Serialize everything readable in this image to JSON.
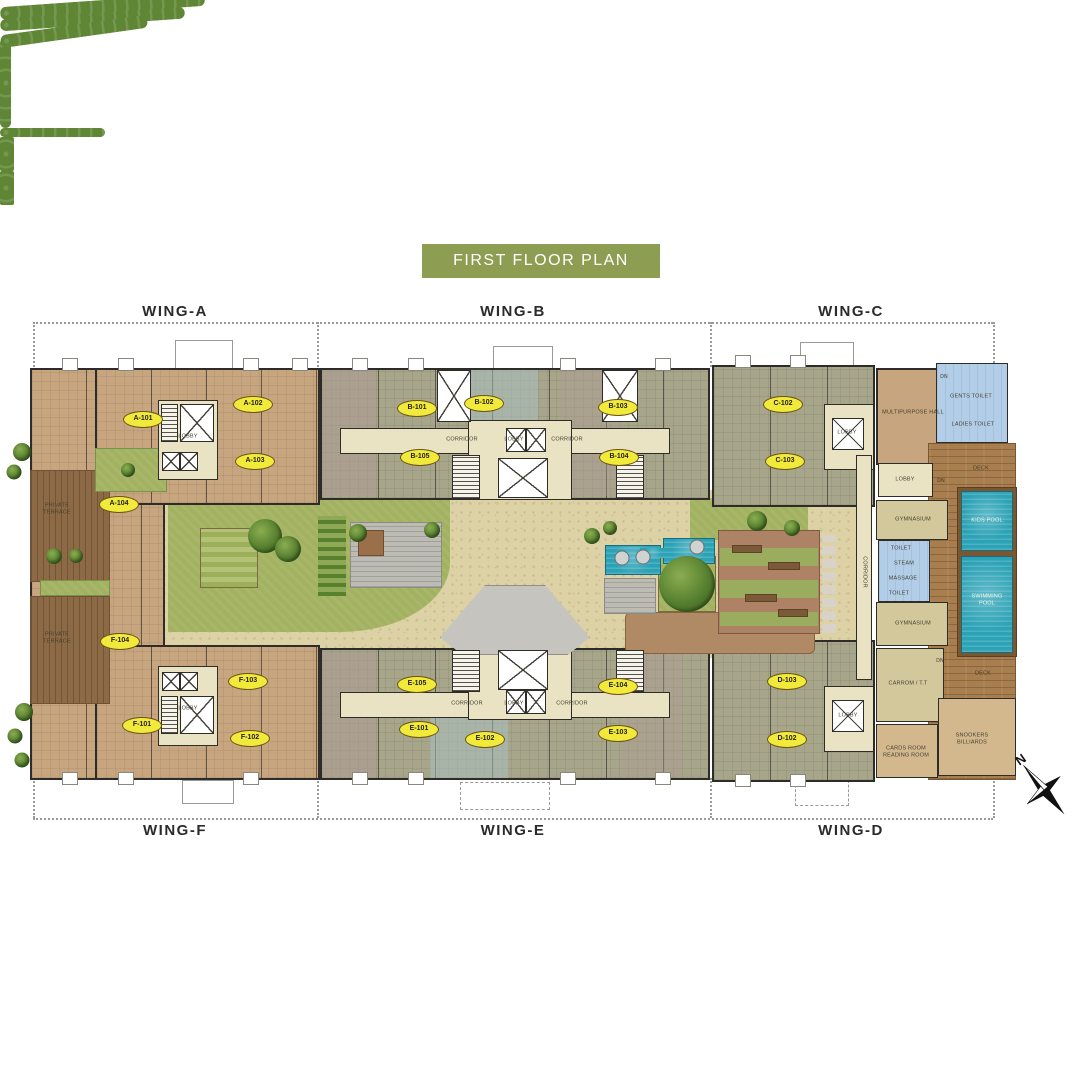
{
  "title": "FIRST FLOOR PLAN",
  "wings": {
    "a": "WING-A",
    "b": "WING-B",
    "c": "WING-C",
    "d": "WING-D",
    "e": "WING-E",
    "f": "WING-F"
  },
  "units": {
    "a101": "A-101",
    "a102": "A-102",
    "a103": "A-103",
    "a104": "A-104",
    "b101": "B-101",
    "b102": "B-102",
    "b103": "B-103",
    "b104": "B-104",
    "b105": "B-105",
    "c102": "C-102",
    "c103": "C-103",
    "d102": "D-102",
    "d103": "D-103",
    "e101": "E-101",
    "e102": "E-102",
    "e103": "E-103",
    "e104": "E-104",
    "e105": "E-105",
    "f101": "F-101",
    "f102": "F-102",
    "f103": "F-103",
    "f104": "F-104"
  },
  "rooms": {
    "lobby": "LOBBY",
    "corridor": "CORRIDOR",
    "multipurpose_hall": "MULTIPURPOSE HALL",
    "gents_toilet": "GENTS TOILET",
    "ladies_toilet": "LADIES TOILET",
    "gymnasium": "GYMNASIUM",
    "toilet": "TOILET",
    "steam": "STEAM",
    "massage": "MASSAGE",
    "kids_pool": "KIDS POOL",
    "swimming_pool": "SWIMMING POOL",
    "deck": "DECK",
    "carrom_tt": "CARROM / T.T",
    "cards_reading": "CARDS ROOM READING ROOM",
    "snookers_billiards": "SNOOKERS BILLIARDS",
    "private_terrace": "PRIVATE TERRACE",
    "dn": "DN"
  },
  "compass": {
    "north": "N"
  },
  "colors": {
    "banner_green": "#8d9e52",
    "unit_label_yellow": "#f2ea3a",
    "apartment_tan": "#c7a57f",
    "apartment_olive": "#a7a58a",
    "lobby_khaki": "#e9e3c4",
    "amenity_khaki": "#d2c89b",
    "toilet_blue": "#b2cde8",
    "deck_wood": "#a87e4e",
    "terrace_wood": "#8d6a45",
    "lawn_green": "#a3b261",
    "hedge_green": "#5e8634",
    "pool_water": "#2ba2b6",
    "stone_path": "#ddd2a6",
    "amphitheatre_brown": "#ae8264",
    "wall_dark": "#2e2c28"
  }
}
